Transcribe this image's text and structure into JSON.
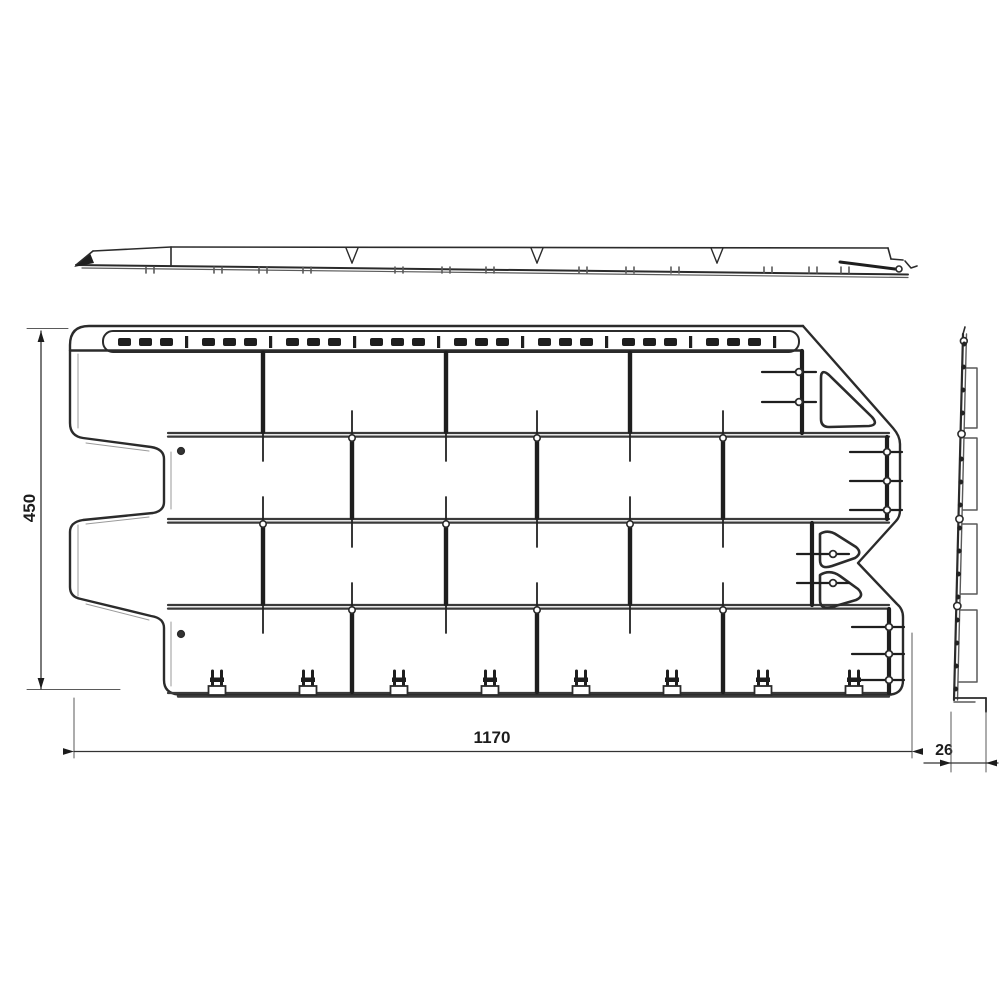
{
  "meta": {
    "drawing_type": "facade-panel-technical-drawing",
    "background_color": "#ffffff",
    "line_color": "#2b2b2b",
    "bold_line_color": "#1e1e1e",
    "thin_line_color": "#5a5a5a"
  },
  "dimensions": {
    "width": {
      "label": "1170"
    },
    "height": {
      "label": "450"
    },
    "thickness": {
      "label": "26"
    }
  },
  "views": {
    "top": {
      "x1": 76,
      "x2": 908,
      "y_top_left": 251,
      "y_top": 247,
      "y_bottom1": 265,
      "y_bottom2": 274,
      "tip": [
        [
          74,
          267
        ],
        [
          90,
          253
        ],
        [
          94,
          263
        ]
      ],
      "step_x": 171,
      "v_notches": [
        352,
        537,
        717
      ],
      "bottom_ticks": [
        150,
        218,
        263,
        307,
        399,
        446,
        490,
        583,
        630,
        675,
        768,
        813,
        845
      ],
      "right_wedge": {
        "x1": 840,
        "y1": 262,
        "x2": 895,
        "y2": 269,
        "circle": [
          899,
          269
        ]
      }
    },
    "front": {
      "rows": [
        {
          "l": 70,
          "r": 802,
          "t": 352,
          "b": 433,
          "joints": [
            263,
            446,
            630
          ]
        },
        {
          "l": 164,
          "r": 887,
          "t": 437,
          "b": 519,
          "joints": [
            352,
            537,
            723
          ]
        },
        {
          "l": 70,
          "r": 812,
          "t": 523,
          "b": 605,
          "joints": [
            263,
            446,
            630
          ]
        },
        {
          "l": 164,
          "r": 889,
          "t": 609,
          "b": 693,
          "joints": [
            352,
            537,
            723
          ]
        }
      ],
      "mortar_y": [
        433,
        519,
        605
      ],
      "mortar_x1": 168,
      "mortar_x2": 889,
      "top_line": {
        "y": 350.5,
        "x1": 70,
        "x2": 802
      },
      "strip": {
        "x1": 103,
        "x2": 799,
        "y1": 331,
        "y2": 352,
        "dash_y": 338,
        "dash_h": 8
      },
      "clips_x": [
        217,
        308,
        399,
        490,
        581,
        672,
        763,
        854
      ],
      "clip_base_y": 694,
      "holes": [
        [
          181,
          451
        ],
        [
          181,
          634
        ]
      ],
      "pin_groups": [
        {
          "ys": [
            372,
            402
          ],
          "x1": 762,
          "x2": 816,
          "cx": 799
        },
        {
          "ys": [
            452,
            481,
            510
          ],
          "x1": 850,
          "x2": 902,
          "cx": 887
        },
        {
          "ys": [
            554,
            583
          ],
          "x1": 797,
          "x2": 849,
          "cx": 833
        },
        {
          "ys": [
            627,
            654,
            680
          ],
          "x1": 852,
          "x2": 904,
          "cx": 889
        }
      ]
    },
    "side": {
      "top_x": 963,
      "top_y": 334,
      "bottom_x": 954,
      "bottom_y": 700,
      "brackets": [
        [
          368,
          428
        ],
        [
          438,
          510
        ],
        [
          524,
          594
        ],
        [
          610,
          682
        ]
      ],
      "bracket_x": 977,
      "dot_step": 23,
      "dot_y1": 344,
      "dot_y2": 692,
      "node_ys": [
        434,
        519,
        606
      ],
      "foot_x2": 986,
      "foot_y": 698,
      "foot_drop": 712
    },
    "dims": {
      "width": {
        "line_y": 751.5,
        "x1": 74,
        "x2": 912,
        "ext_left": [
          74,
          698,
          758
        ],
        "ext_right": [
          912,
          633,
          758
        ],
        "label_x": 492,
        "label_y": 743
      },
      "height": {
        "line_x": 41,
        "y1": 331,
        "y2": 689,
        "ext_top": [
          328.5,
          27,
          68
        ],
        "ext_bottom": [
          689.5,
          27,
          120
        ],
        "label_x": 35,
        "label_y": 508
      },
      "thickness": {
        "x1": 951,
        "x2": 986,
        "line_y": 763,
        "line_x1": 924,
        "line_x2": 998,
        "ext_y1": 712,
        "ext_y2": 772,
        "label_x": 944,
        "label_y": 755
      }
    }
  }
}
